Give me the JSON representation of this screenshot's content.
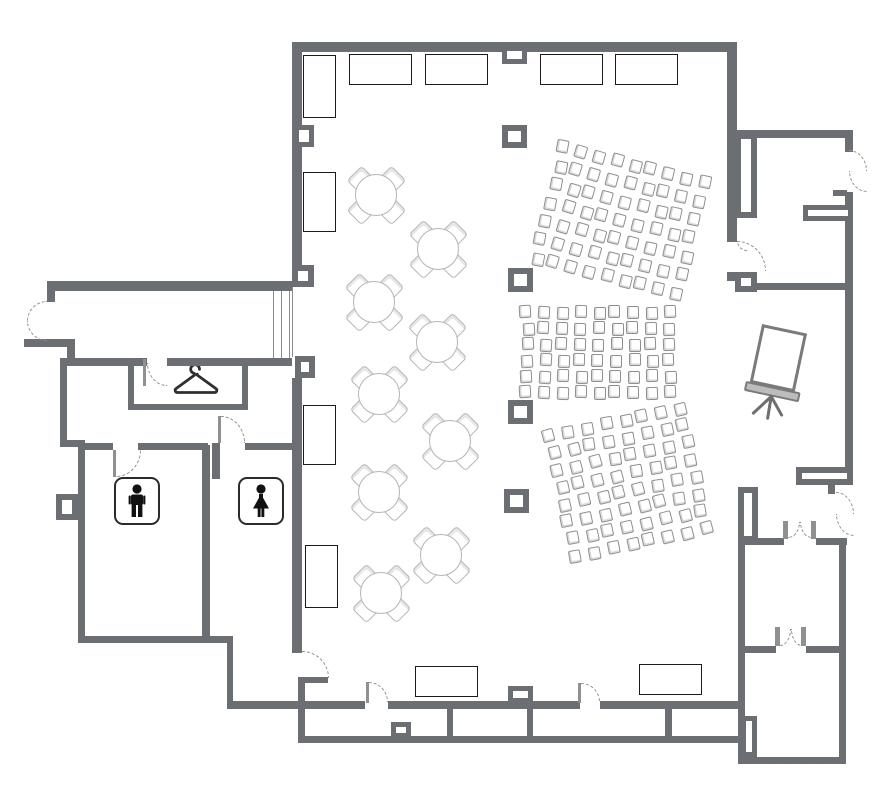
{
  "title": "Banquet hall floor plan",
  "canvas": {
    "width": 894,
    "height": 807
  },
  "colors": {
    "wall": "#6b6f73",
    "table_border": "#1b1b1b",
    "chair_outline": "#8f8f8f",
    "chair_shade": "#d8d8d8",
    "round_outline": "#b5b5b5",
    "door_dash": "#909090",
    "thin_line": "#8c8c8c",
    "icon": "#111111",
    "screen_frame": "#7a7a7a"
  },
  "floorplan": {
    "walls": [
      [
        292,
        42,
        445,
        10
      ],
      [
        292,
        52,
        10,
        213
      ],
      [
        292,
        378,
        10,
        275
      ],
      [
        727,
        52,
        10,
        190
      ],
      [
        727,
        272,
        30,
        9
      ],
      [
        227,
        701,
        138,
        8
      ],
      [
        388,
        701,
        192,
        8
      ],
      [
        600,
        701,
        138,
        8
      ],
      [
        735,
        130,
        118,
        8
      ],
      [
        845,
        138,
        8,
        14
      ],
      [
        845,
        192,
        8,
        293
      ],
      [
        833,
        190,
        14,
        6
      ],
      [
        755,
        283,
        92,
        7
      ],
      [
        738,
        538,
        7,
        226
      ],
      [
        738,
        538,
        46,
        7
      ],
      [
        816,
        538,
        31,
        7
      ],
      [
        839,
        538,
        7,
        226
      ],
      [
        741,
        757,
        103,
        7
      ],
      [
        741,
        646,
        35,
        7
      ],
      [
        806,
        646,
        35,
        7
      ],
      [
        828,
        478,
        7,
        16
      ],
      [
        298,
        677,
        7,
        66
      ],
      [
        298,
        677,
        30,
        6
      ],
      [
        298,
        736,
        442,
        7
      ],
      [
        447,
        709,
        6,
        27
      ],
      [
        527,
        709,
        6,
        27
      ],
      [
        665,
        707,
        7,
        30
      ],
      [
        47,
        281,
        245,
        10
      ],
      [
        47,
        281,
        8,
        21
      ],
      [
        24,
        339,
        50,
        8
      ],
      [
        67,
        339,
        8,
        27
      ],
      [
        75,
        358,
        72,
        8
      ],
      [
        167,
        358,
        125,
        8
      ],
      [
        60,
        358,
        7,
        89
      ],
      [
        60,
        440,
        25,
        7
      ],
      [
        78,
        447,
        7,
        196
      ],
      [
        78,
        636,
        155,
        7
      ],
      [
        227,
        643,
        6,
        64
      ],
      [
        85,
        443,
        28,
        7
      ],
      [
        138,
        443,
        70,
        7
      ],
      [
        202,
        445,
        8,
        198
      ],
      [
        212,
        443,
        8,
        36
      ],
      [
        245,
        443,
        57,
        7
      ],
      [
        128,
        358,
        6,
        52
      ],
      [
        128,
        404,
        120,
        6
      ],
      [
        242,
        358,
        6,
        52
      ]
    ],
    "columns": [
      [
        502,
        46,
        25,
        18,
        5
      ],
      [
        294,
        125,
        20,
        22,
        5
      ],
      [
        292,
        265,
        22,
        22,
        6
      ],
      [
        295,
        356,
        20,
        22,
        6
      ],
      [
        502,
        125,
        25,
        23,
        6
      ],
      [
        508,
        268,
        25,
        24,
        6
      ],
      [
        508,
        400,
        25,
        24,
        6
      ],
      [
        504,
        489,
        25,
        24,
        6
      ],
      [
        508,
        686,
        25,
        17,
        5
      ],
      [
        391,
        722,
        20,
        16,
        5
      ],
      [
        735,
        272,
        22,
        20,
        6
      ],
      [
        56,
        494,
        22,
        26,
        6
      ],
      [
        803,
        205,
        50,
        16,
        5
      ],
      [
        796,
        467,
        57,
        18,
        6
      ],
      [
        735,
        133,
        22,
        85,
        6
      ],
      [
        738,
        487,
        20,
        55,
        6
      ],
      [
        741,
        716,
        16,
        41,
        5
      ]
    ],
    "tables_rect": [
      [
        303,
        55,
        33,
        63
      ],
      [
        349,
        54,
        63,
        31
      ],
      [
        425,
        54,
        63,
        31
      ],
      [
        540,
        54,
        63,
        31
      ],
      [
        615,
        54,
        63,
        31
      ],
      [
        303,
        172,
        33,
        60
      ],
      [
        303,
        405,
        33,
        60
      ],
      [
        305,
        545,
        33,
        63
      ],
      [
        415,
        666,
        63,
        31
      ],
      [
        639,
        664,
        63,
        31
      ]
    ],
    "tables_round": [
      [
        376,
        195
      ],
      [
        438,
        249
      ],
      [
        374,
        302
      ],
      [
        437,
        342
      ],
      [
        379,
        394
      ],
      [
        450,
        441
      ],
      [
        379,
        492
      ],
      [
        441,
        555
      ],
      [
        381,
        593
      ]
    ],
    "seating_blocks": [
      {
        "x": 560,
        "y": 140,
        "cols": 9,
        "rows": 7,
        "sx": 18,
        "sy": 19,
        "rot": 14
      },
      {
        "x": 521,
        "y": 306,
        "cols": 9,
        "rows": 6,
        "sx": 17.8,
        "sy": 16,
        "rot": 0
      },
      {
        "x": 543,
        "y": 431,
        "cols": 8,
        "rows": 8,
        "sx": 19,
        "sy": 17.5,
        "rot": -12
      }
    ],
    "stair_lines": [
      [
        273,
        291,
        67
      ],
      [
        281,
        291,
        67
      ],
      [
        289,
        291,
        67
      ],
      [
        292,
        287,
        70
      ]
    ],
    "doors": [
      [
        302,
        651,
        27,
        27,
        "tr"
      ],
      [
        369,
        682,
        19,
        20,
        "tr"
      ],
      [
        581,
        683,
        19,
        19,
        "tr"
      ],
      [
        737,
        241,
        29,
        30,
        "tr"
      ],
      [
        737,
        241,
        10,
        10,
        "bl"
      ],
      [
        116,
        450,
        25,
        27,
        "br"
      ],
      [
        221,
        416,
        24,
        27,
        "tr"
      ],
      [
        147,
        363,
        20,
        23,
        "bl"
      ],
      [
        27,
        301,
        20,
        20,
        "tl"
      ],
      [
        27,
        321,
        20,
        20,
        "bl"
      ],
      [
        788,
        522,
        12,
        16,
        "br"
      ],
      [
        800,
        522,
        12,
        16,
        "bl"
      ],
      [
        780,
        629,
        11,
        17,
        "br"
      ],
      [
        791,
        629,
        11,
        17,
        "bl"
      ],
      [
        849,
        150,
        18,
        21,
        "tr"
      ],
      [
        849,
        171,
        18,
        21,
        "bl"
      ],
      [
        836,
        492,
        18,
        22,
        "tr"
      ],
      [
        836,
        514,
        18,
        22,
        "bl"
      ]
    ],
    "door_leaves": [
      [
        366,
        682,
        3,
        21
      ],
      [
        578,
        683,
        3,
        20
      ],
      [
        113,
        450,
        3,
        27
      ],
      [
        218,
        416,
        3,
        27
      ],
      [
        143,
        359,
        3,
        27
      ],
      [
        783,
        521,
        5,
        18
      ],
      [
        811,
        521,
        5,
        18
      ],
      [
        775,
        627,
        5,
        19
      ],
      [
        801,
        627,
        5,
        19
      ]
    ],
    "icons": {
      "coat_hanger": {
        "name": "coat-hanger-icon",
        "x": 172,
        "y": 363
      },
      "mens_restroom": {
        "name": "mens-restroom-icon",
        "x": 114,
        "y": 477
      },
      "womens_restroom": {
        "name": "womens-restroom-icon",
        "x": 238,
        "y": 477
      },
      "projection_screen": {
        "name": "projection-screen",
        "x": 748,
        "y": 328,
        "rot": 12
      }
    },
    "counts": {
      "round_tables": 9,
      "rect_tables": 10,
      "theater_seating_blocks": 3
    }
  }
}
